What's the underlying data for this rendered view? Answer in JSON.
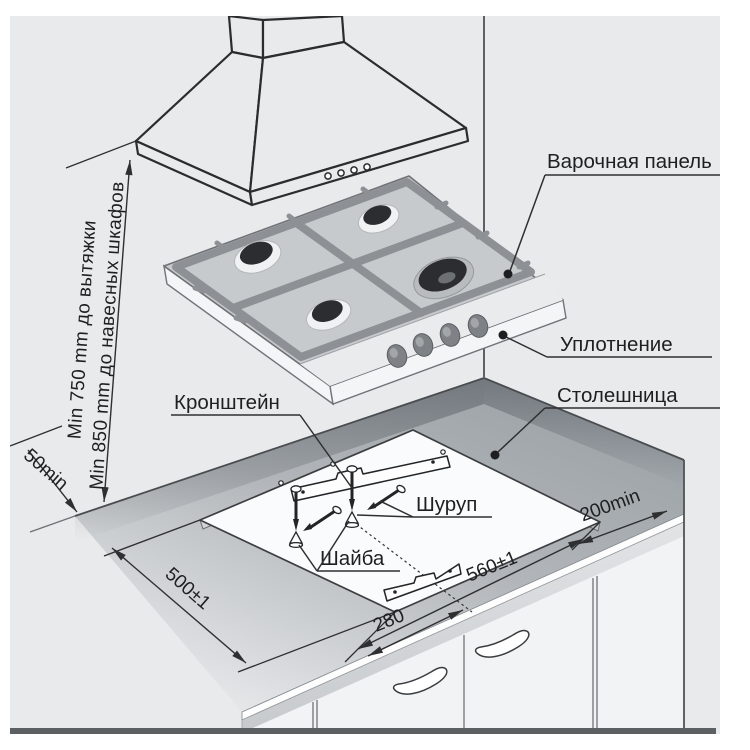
{
  "diagram": {
    "labels": {
      "panel": "Варочная панель",
      "seal": "Уплотнение",
      "countertop": "Столешница",
      "bracket": "Кронштейн",
      "screw": "Шуруп",
      "washer": "Шайба"
    },
    "dimensions": {
      "hood_clearance": "Min 750 mm до вытяжки",
      "cabinet_clearance": "Min 850 mm до навесных шкафов",
      "rear_gap": "50min",
      "cutout_depth": "500±1",
      "cutout_width": "560±1",
      "bracket_spacing": "280",
      "side_clearance": "200min"
    }
  },
  "colors": {
    "background": "#e9eaec",
    "line": "#2b2c2e",
    "countertop_dark": "#9aa0a5",
    "countertop_light": "#eef0f1",
    "cutout": "#fafbfc",
    "cooktop_top": "#c7cacd",
    "grate": "#8d9195",
    "burner": "#2b2d30",
    "cabinet": "#f2f3f5"
  }
}
